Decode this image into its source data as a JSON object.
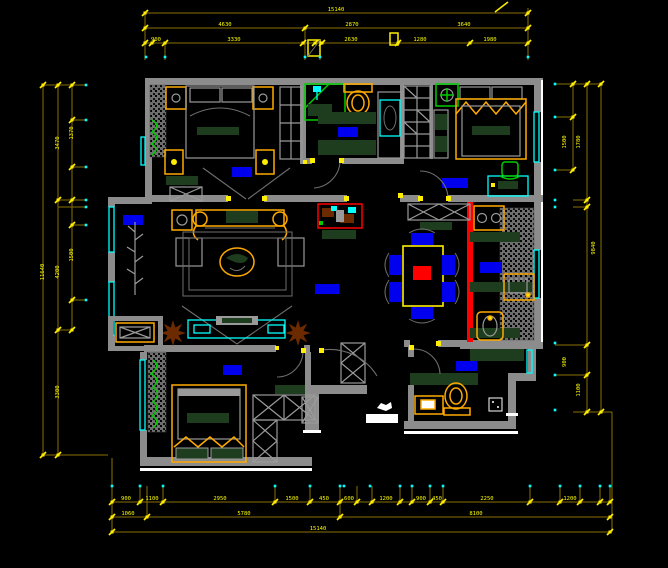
{
  "meta": {
    "drawing_type": "apartment-floor-plan-cad",
    "background": "#000000"
  },
  "colors": {
    "wall_gray": "#8c8c8c",
    "dimension_line": "#8a7000",
    "dimension_text": "#ffff00",
    "window_cyan": "#00ffff",
    "room_label_blue": "#0000dd",
    "accent_red": "#ff0000",
    "accent_green": "#00cc00",
    "furniture_dark_green": "#1e3d1e",
    "furniture_orange": "#ffaa00",
    "plant_brown": "#6b2a00",
    "white_trim": "#ffffff"
  },
  "dims": {
    "top": {
      "row1": [
        "15140"
      ],
      "row2": [
        "4630",
        "2870",
        "3640"
      ],
      "row3": [
        "900",
        "3330",
        "2630",
        "1280",
        "1980"
      ]
    },
    "left": {
      "row1": [
        "11640"
      ],
      "row2": [
        "3470",
        "4200",
        "3300"
      ],
      "row3": [
        "1370",
        "1500"
      ]
    },
    "right": {
      "row1": [
        "1500",
        "1780"
      ],
      "row2": [
        "9840"
      ],
      "row3": [
        "900",
        "1100"
      ]
    },
    "bottom": {
      "row1": [
        "900",
        "1100",
        "2950",
        "1500",
        "450",
        "600",
        "1200",
        "900",
        "450",
        "2250",
        "1200"
      ],
      "row2": [
        "1060",
        "5780",
        "8100"
      ],
      "row3": [
        "15140"
      ]
    }
  }
}
